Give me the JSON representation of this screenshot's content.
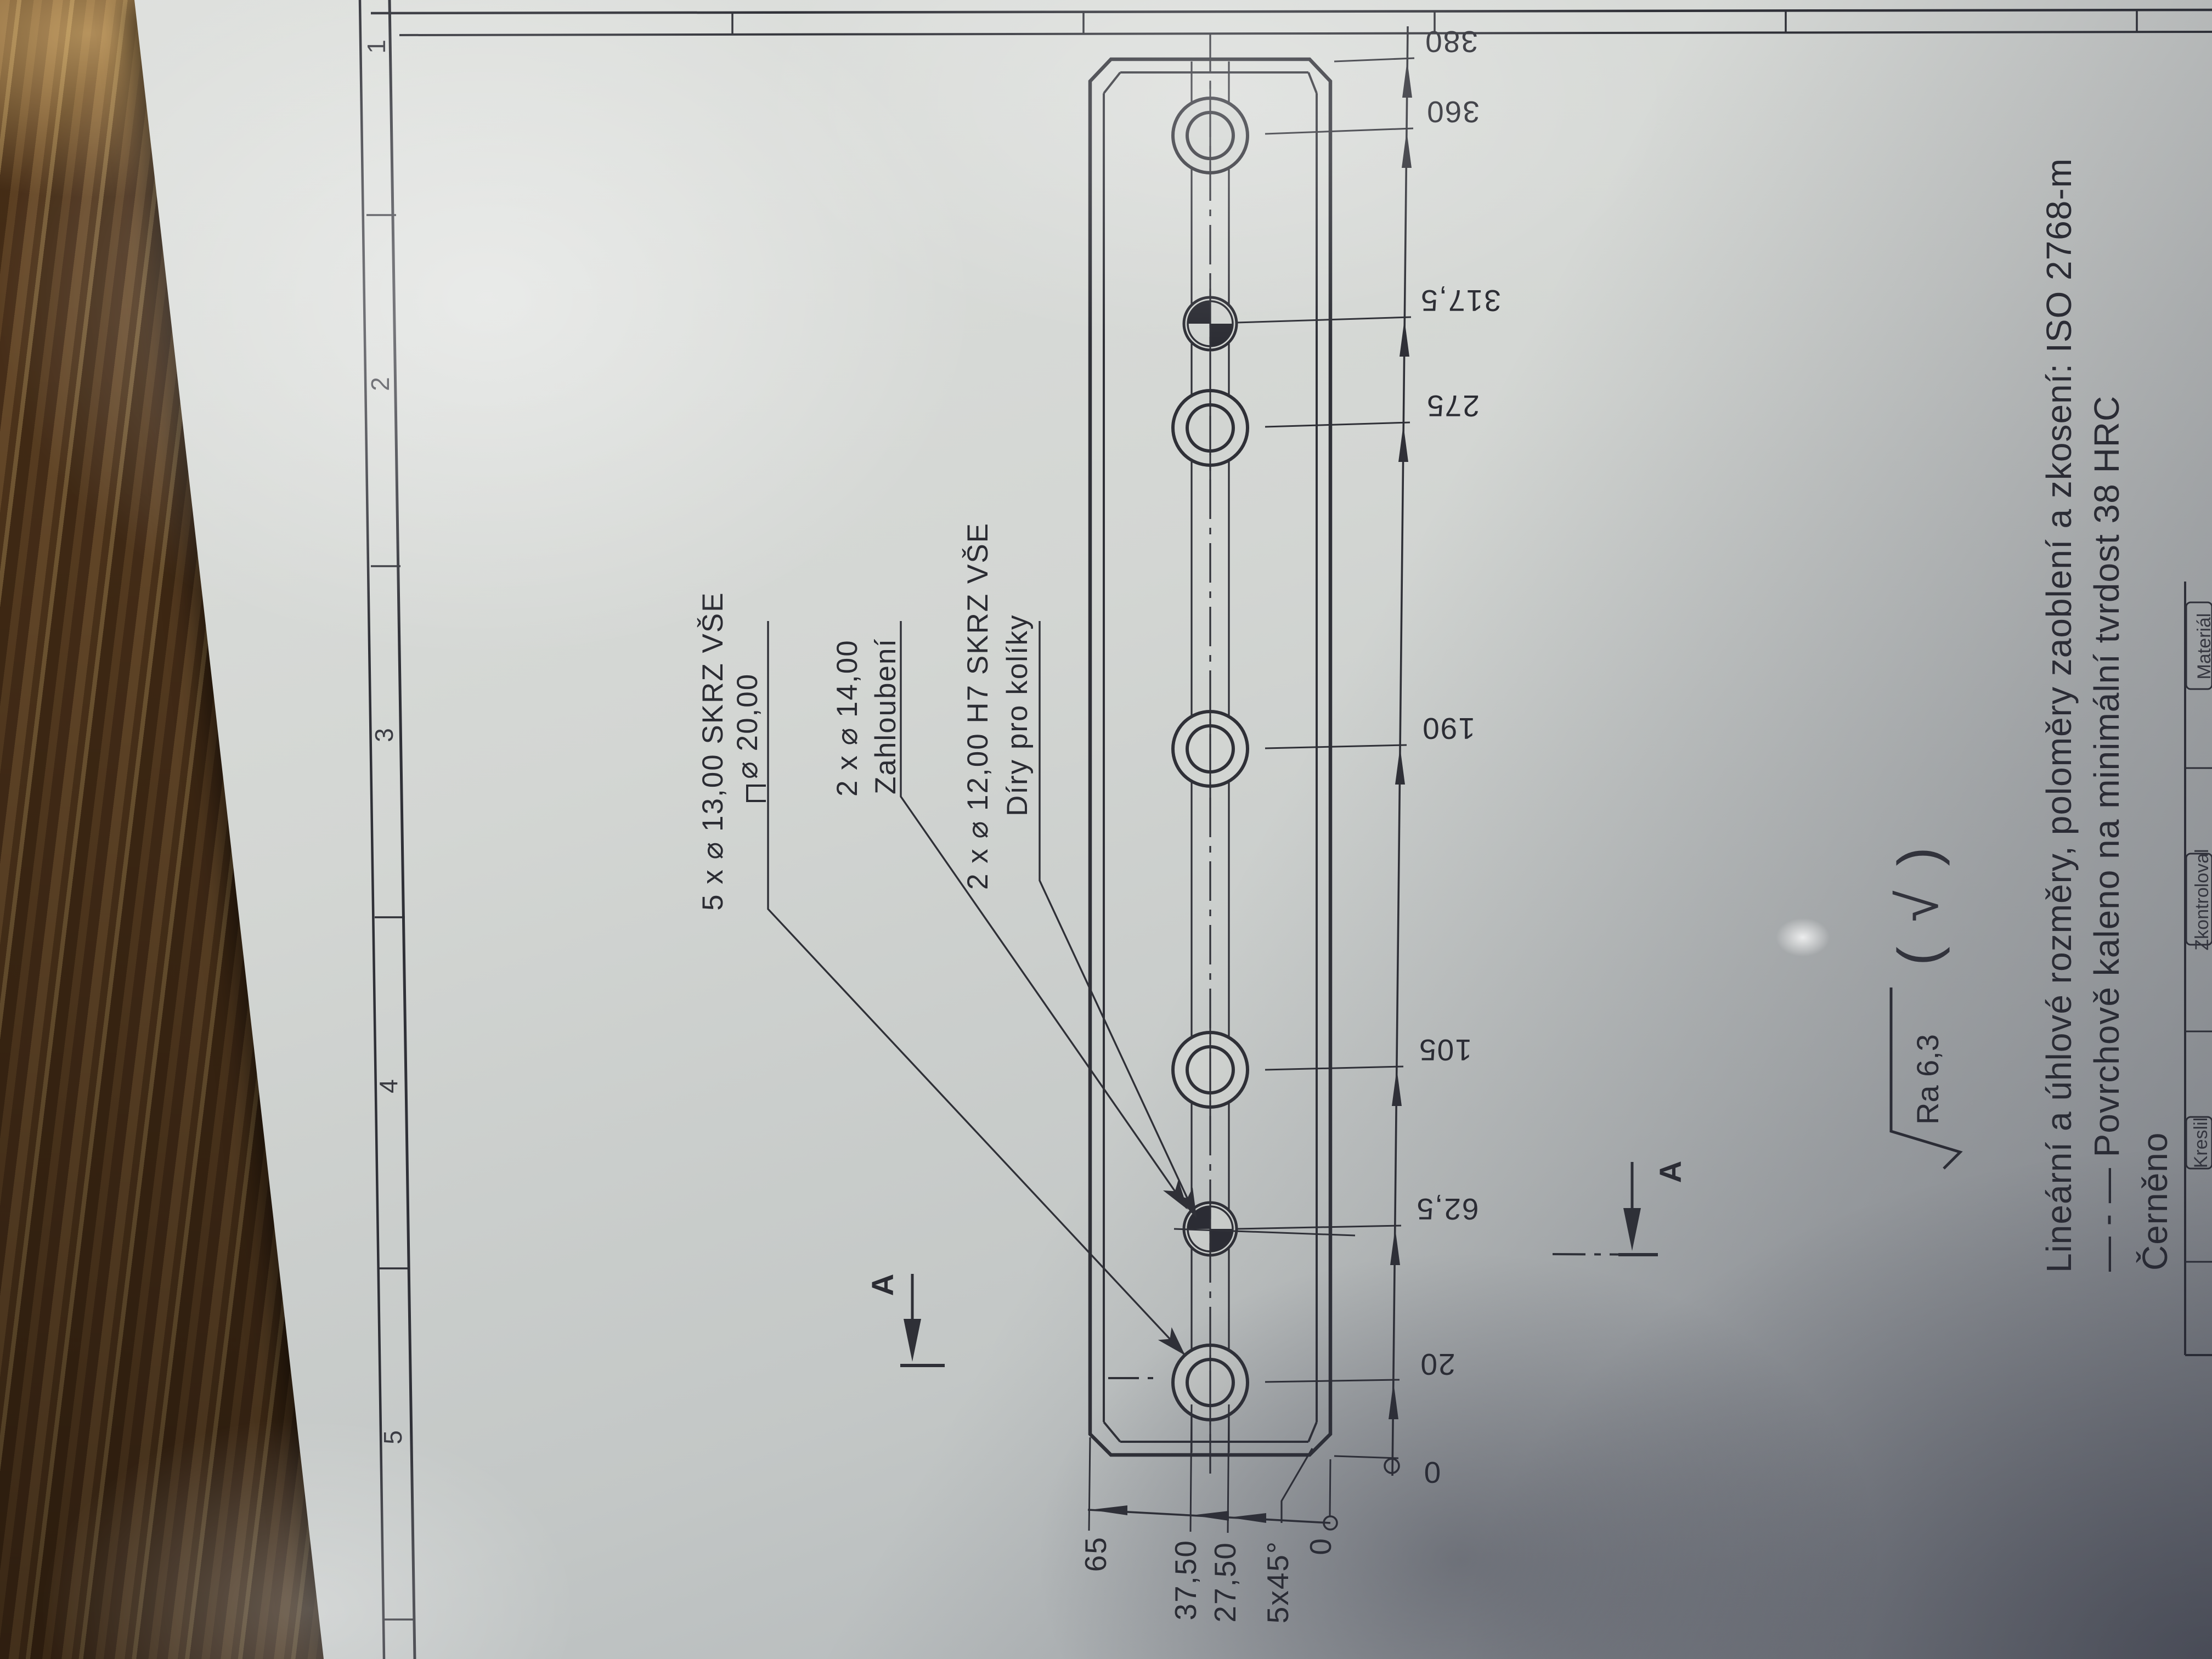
{
  "callouts": {
    "counterbore": {
      "line1": "5 x ⌀ 13,00 SKRZ VŠE",
      "line2": "⌀ 20,00"
    },
    "spotface": {
      "line1": "2 x ⌀ 14,00",
      "line2": "Zahloubení"
    },
    "dowel": {
      "line1": "2 x ⌀ 12,00 H7 SKRZ VŠE",
      "line2": "Díry pro kolíky"
    }
  },
  "dims": {
    "run": [
      "380",
      "360",
      "317,5",
      "275",
      "190",
      "105",
      "62,5",
      "20",
      "0"
    ],
    "width": [
      "65",
      "37,50",
      "27,50",
      "5x45°",
      "0"
    ]
  },
  "section": {
    "label_left": "A",
    "label_right": "A"
  },
  "surface": {
    "ra": "Ra 6,3",
    "basic": "( √ )"
  },
  "notes": {
    "tolerances": "Lineární a úhlové rozměry, poloměry zaoblení a zkosení: ISO 2768-m",
    "hardening": "— - — Povrchově kaleno na minimální tvrdost 38 HRC",
    "finish": "Černěno"
  },
  "titleblock": {
    "drawn_by": "Kreslil",
    "checked_by": "Zkontroloval",
    "material": "Materiál"
  },
  "frame": {
    "zones": [
      "1",
      "2",
      "3",
      "4",
      "5"
    ]
  }
}
